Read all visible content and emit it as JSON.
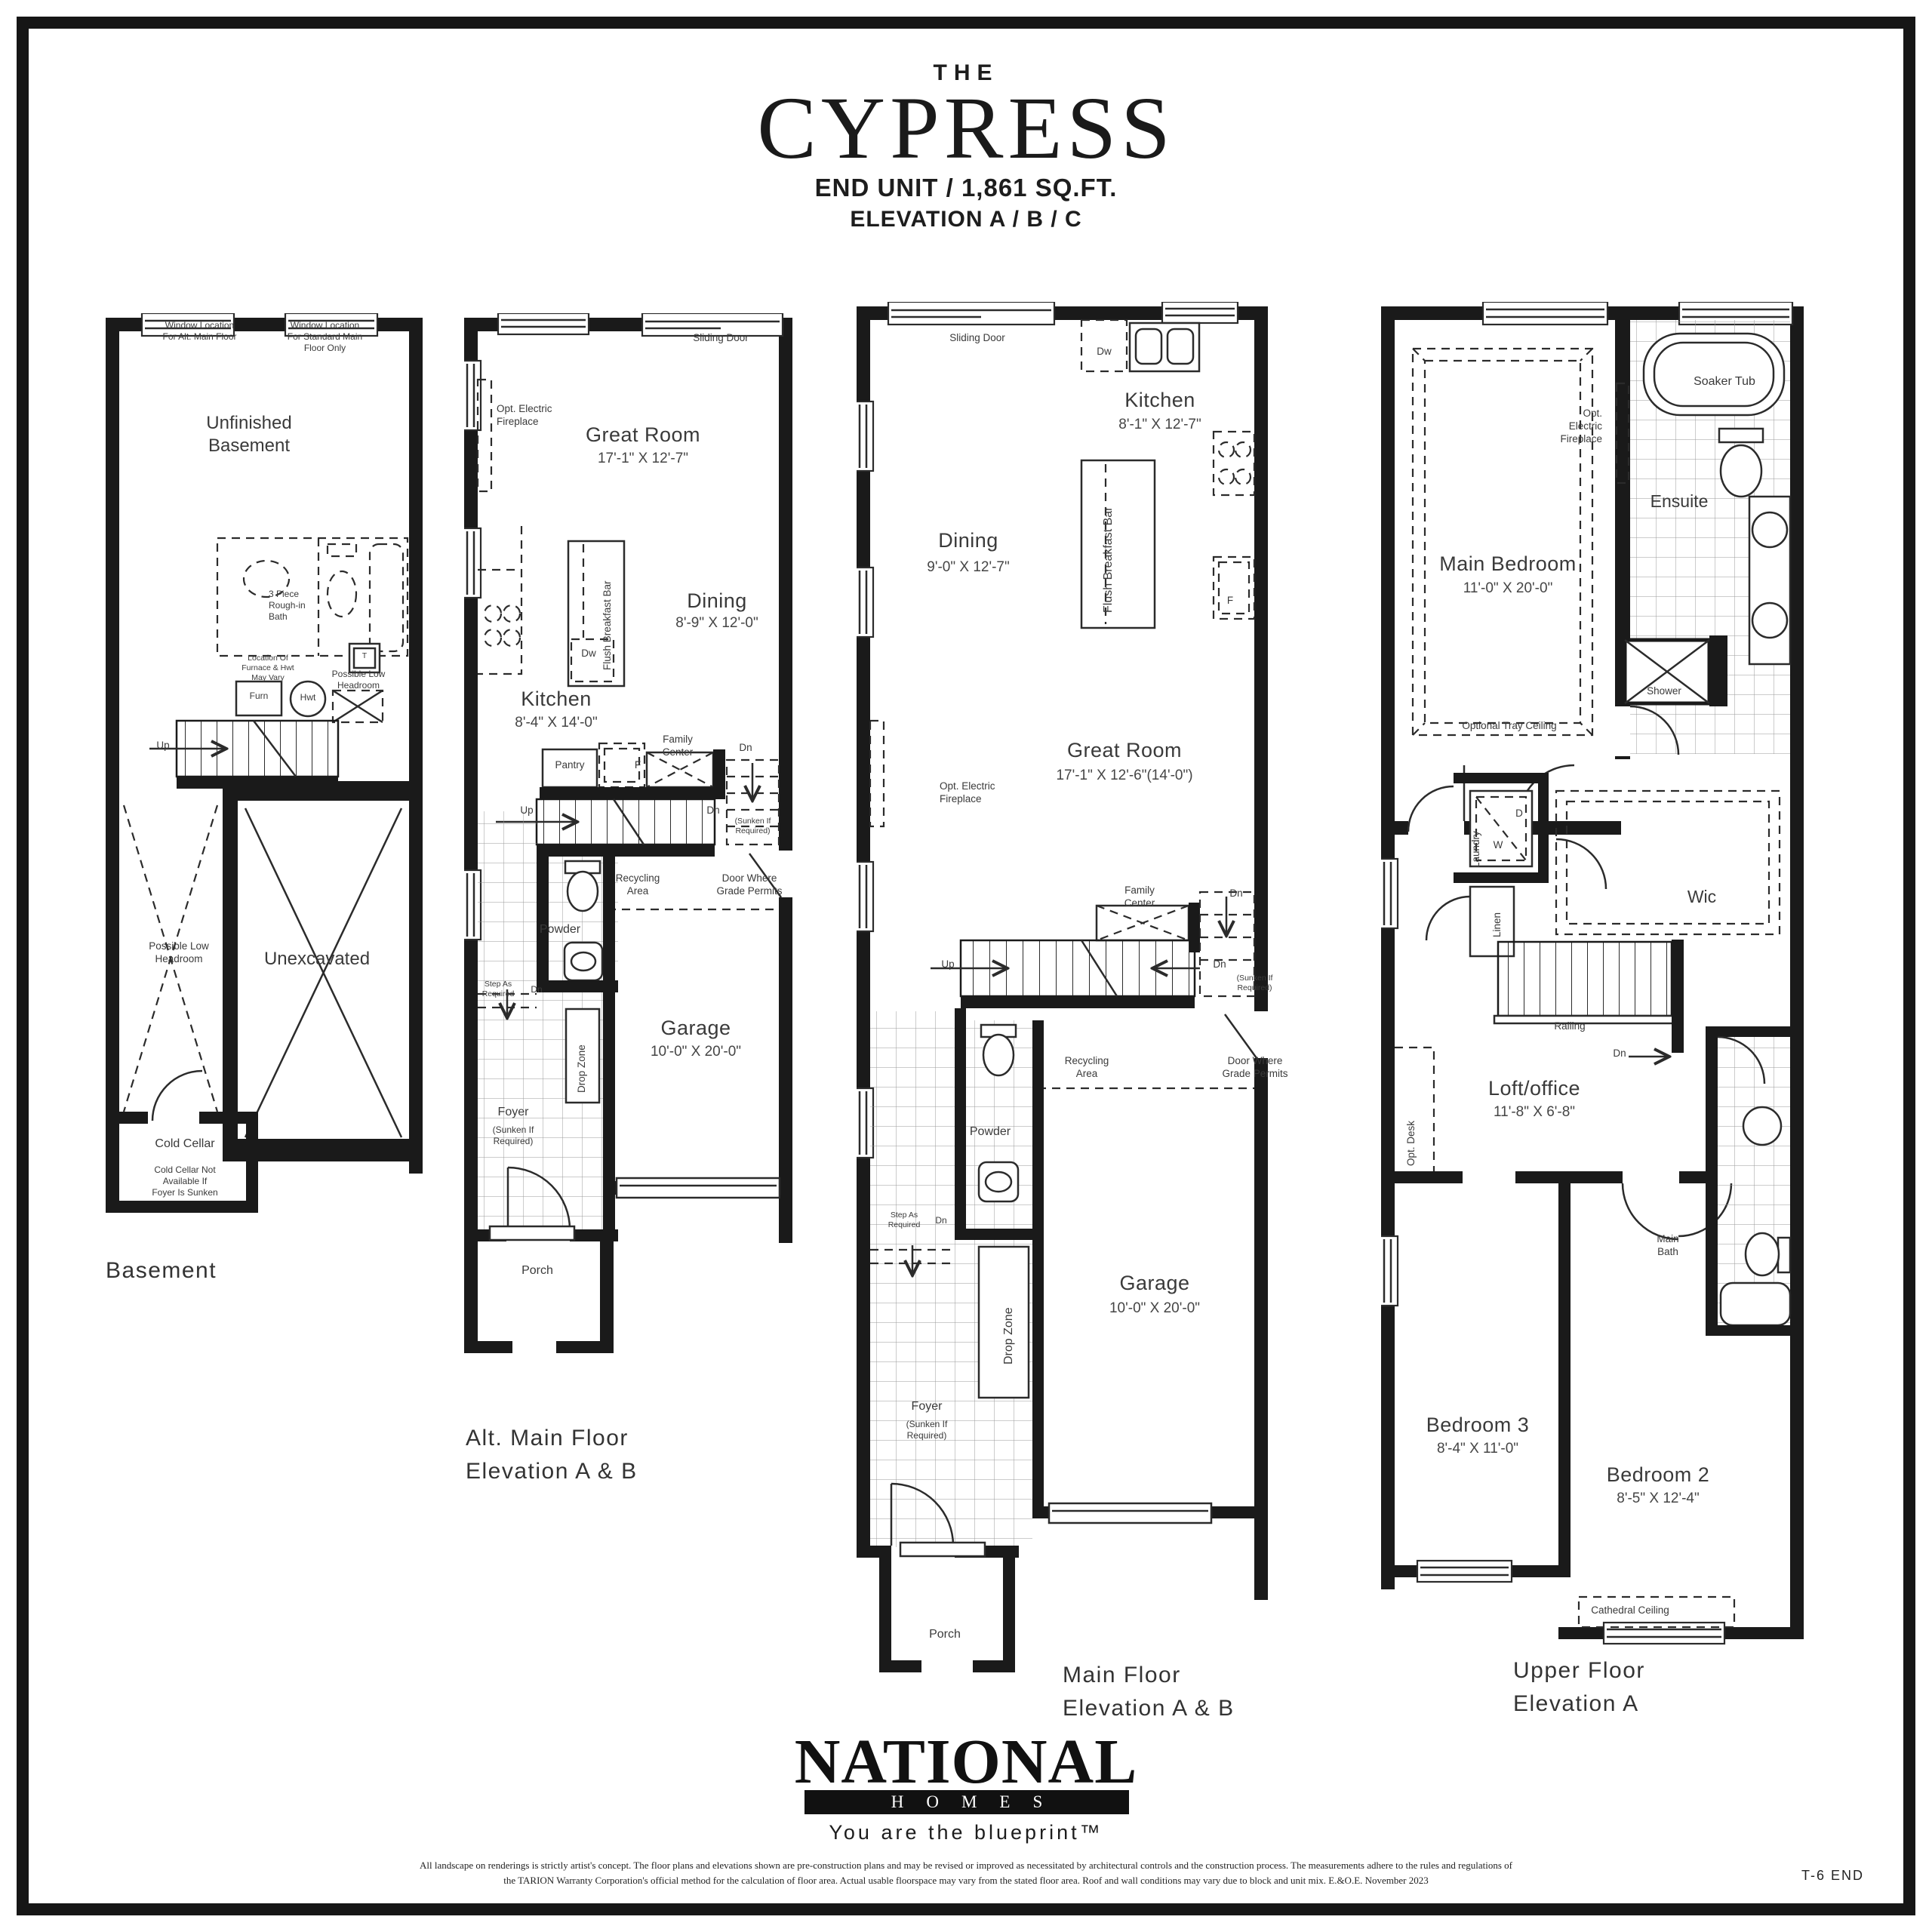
{
  "title": {
    "kicker": "THE",
    "name": "CYPRESS",
    "spec": "END UNIT / 1,861 SQ.FT.",
    "elevation": "ELEVATION A / B / C"
  },
  "common": {
    "dn": "Dn",
    "up": "Up",
    "sliding_door": "Sliding Door",
    "fireplace": "Opt. Electric\nFireplace",
    "family_center": "Family\nCenter",
    "recycling": "Recycling\nArea",
    "door_grade": "Door Where\nGrade Permits",
    "powder": "Powder",
    "step_req": "Step As\nRequired",
    "drop_zone": "Drop Zone",
    "garage": "Garage",
    "foyer": "Foyer",
    "sunken": "(Sunken If\nRequired)",
    "porch": "Porch",
    "breakfast_bar": "Flush Breakfast Bar",
    "dw": "Dw",
    "f": "F",
    "kitchen": "Kitchen",
    "dining": "Dining",
    "great_room": "Great Room"
  },
  "basement": {
    "label": "Basement",
    "win_alt": "Window Location\nFor Alt. Main Floor",
    "win_std": "Window Location\nFor Standard Main\nFloor Only",
    "unfinished": "Unfinished\nBasement",
    "bath": "3 Piece\nRough-in\nBath",
    "furnace_note": "Location Of\nFurnace & Hwt\nMay Vary",
    "furn": "Furn",
    "hwt": "Hwt",
    "t": "T",
    "low_headroom": "Possible Low\nHeadroom",
    "unexcavated": "Unexcavated",
    "cold_cellar": "Cold Cellar",
    "cold_note": "Cold Cellar Not\nAvailable If\nFoyer Is Sunken"
  },
  "alt_main": {
    "label": "Alt. Main Floor\nElevation A & B",
    "great_dims": "17'-1\" X 12'-7\"",
    "dining_dims": "8'-9\" X 12'-0\"",
    "kitchen_dims": "8'-4\" X 14'-0\"",
    "garage_dims": "10'-0\" X 20'-0\"",
    "pantry": "Pantry"
  },
  "main": {
    "label": "Main Floor\nElevation A & B",
    "kitchen_dims": "8'-1\" X 12'-7\"",
    "dining_dims": "9'-0\" X 12'-7\"",
    "great_dims": "17'-1\" X 12'-6\"(14'-0\")",
    "garage_dims": "10'-0\" X 20'-0\""
  },
  "upper": {
    "label": "Upper Floor\nElevation A",
    "soaker": "Soaker Tub",
    "fireplace3": "Opt.\nElectric\nFireplace",
    "ensuite": "Ensuite",
    "main_bedroom": "Main Bedroom",
    "main_bedroom_dims": "11'-0\" X 20'-0\"",
    "tray": "Optional Tray Ceiling",
    "shower": "Shower",
    "laundry": "Laundry",
    "d": "D",
    "w": "W",
    "linen": "Linen",
    "wic": "Wic",
    "railing": "Railing",
    "loft": "Loft/office",
    "loft_dims": "11'-8\" X 6'-8\"",
    "opt_desk": "Opt. Desk",
    "main_bath": "Main\nBath",
    "bed3": "Bedroom 3",
    "bed3_dims": "8'-4\" X 11'-0\"",
    "bed2": "Bedroom 2",
    "bed2_dims": "8'-5\" X 12'-4\"",
    "cathedral": "Cathedral Ceiling"
  },
  "logo": {
    "national": "NATIONAL",
    "homes": "HOMES",
    "tagline": "You are the blueprint™"
  },
  "footer": {
    "line1": "All landscape on renderings is strictly artist's concept. The floor plans and elevations shown are pre-construction plans and may be revised or improved as necessitated by architectural controls and the construction process. The measurements adhere to the rules and regulations of",
    "line2": "the TARION Warranty Corporation's official method for the calculation of floor area. Actual usable floorspace may vary from the stated floor area. Roof and wall conditions may vary due to block and unit mix.  E.&O.E. November 2023",
    "sheet": "T-6 END"
  }
}
